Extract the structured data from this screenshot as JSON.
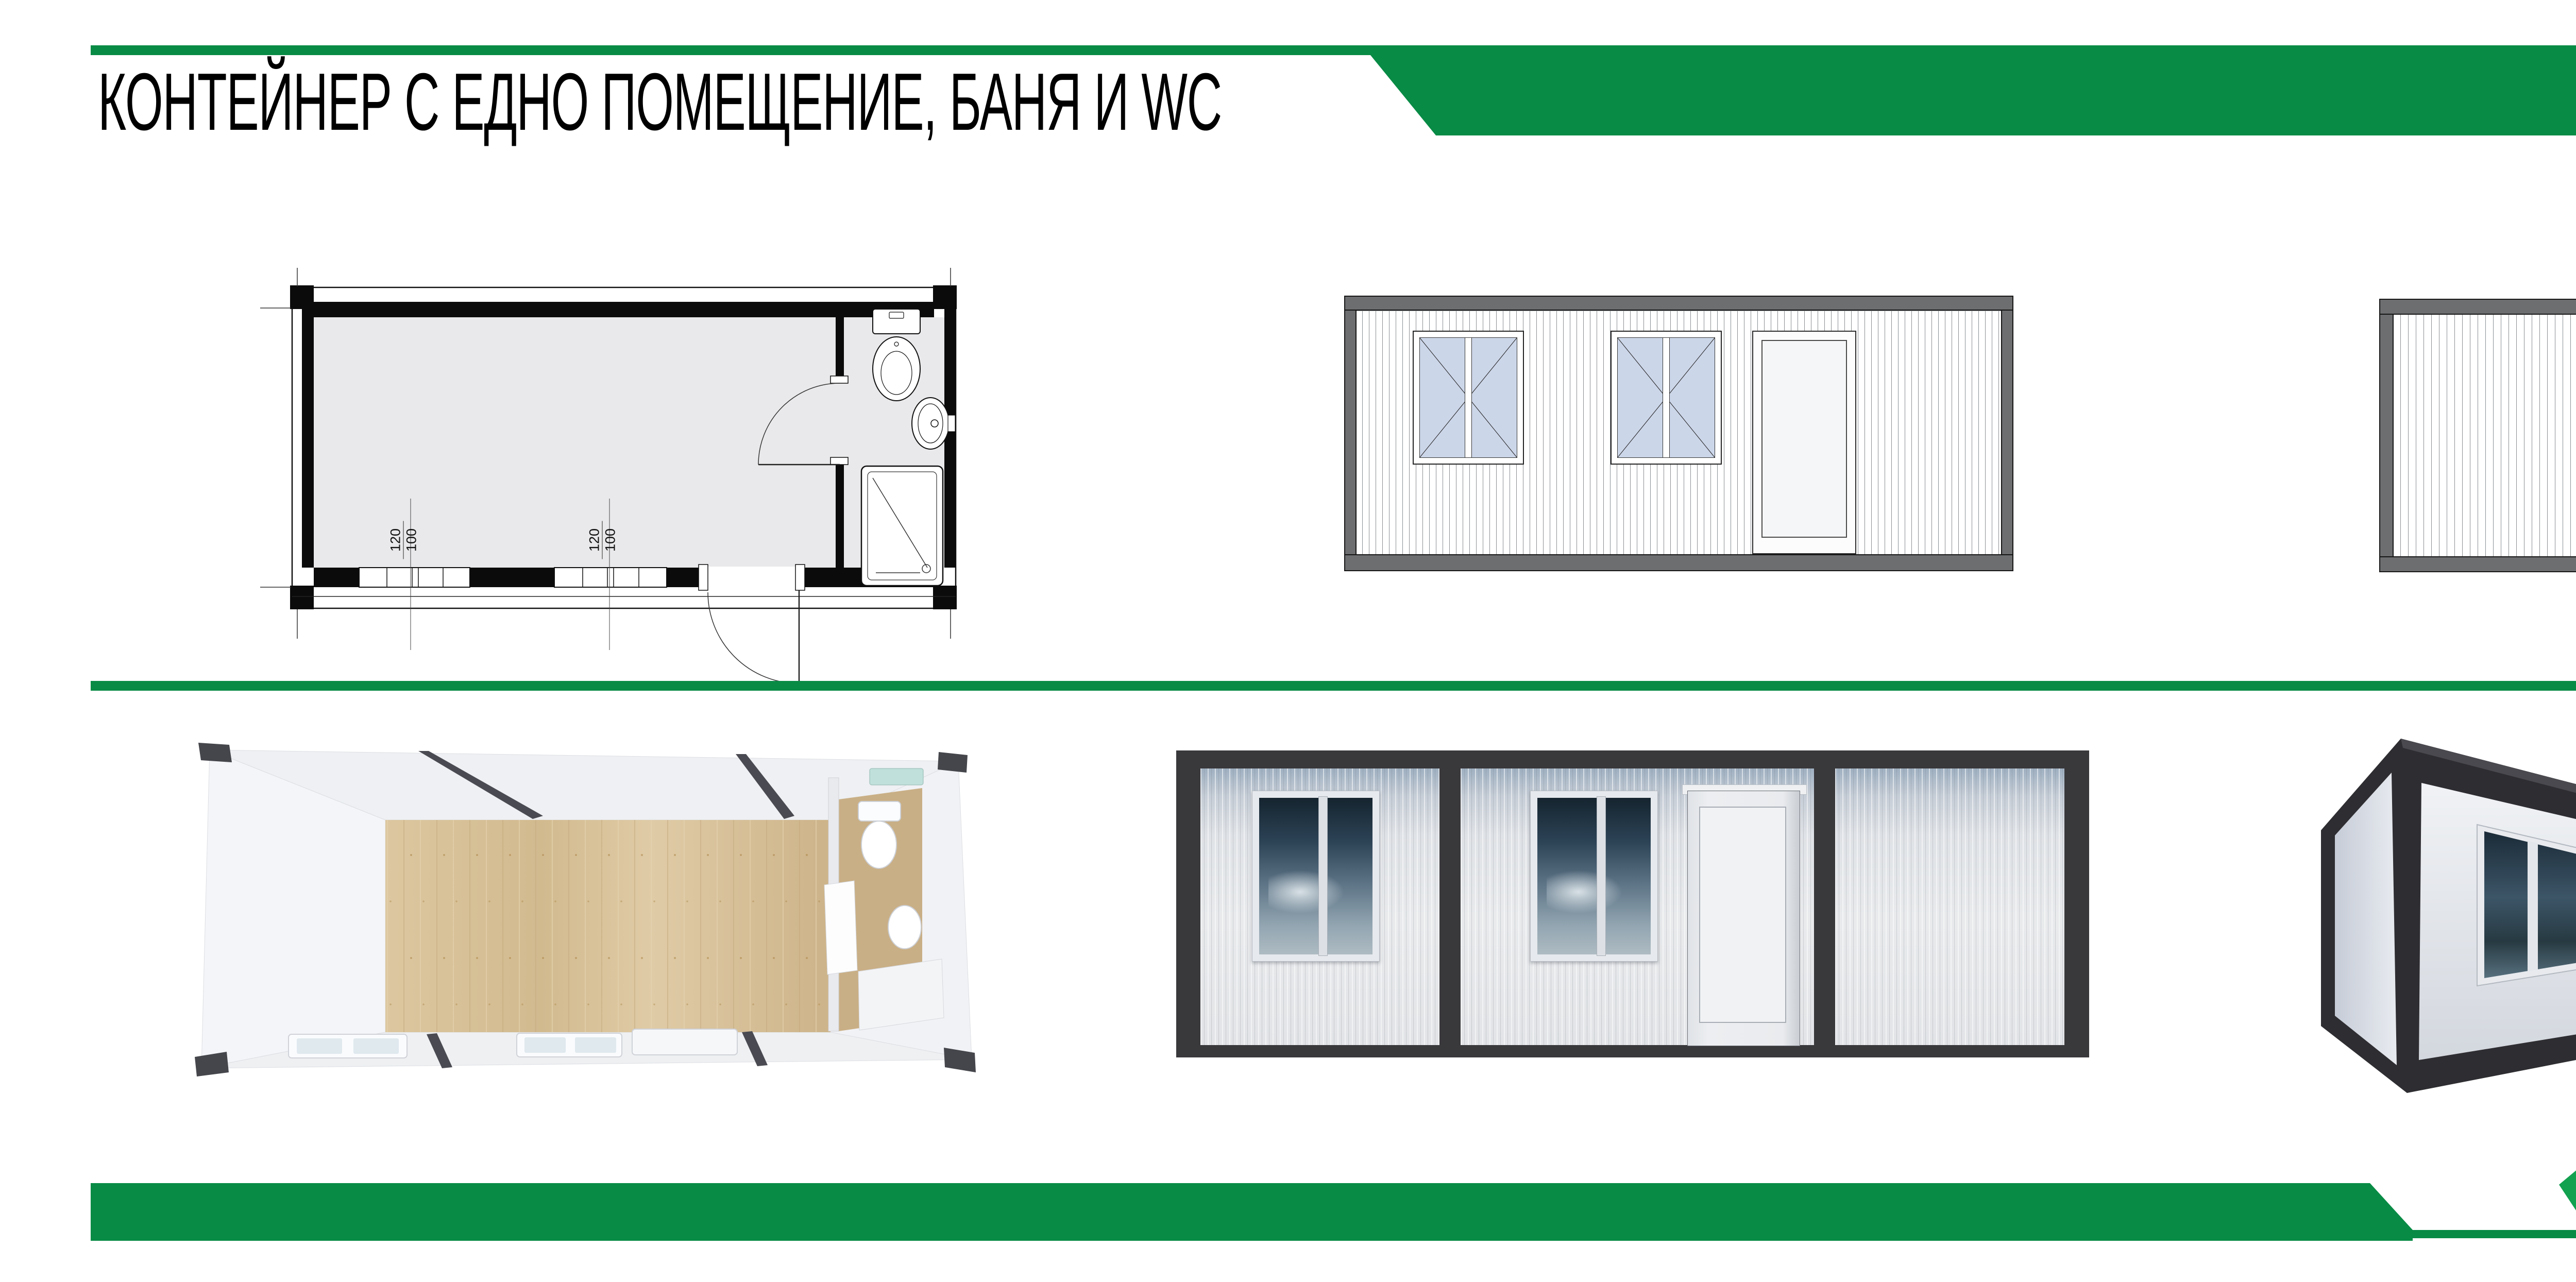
{
  "header": {
    "title": "КОНТЕЙНЕР С ЕДНО ПОМЕЩЕНИЕ, БАНЯ И WC",
    "page_number": "0 0 8"
  },
  "plan": {
    "dims": [
      {
        "width": "120",
        "height": "100"
      },
      {
        "width": "120",
        "height": "100"
      }
    ]
  },
  "footer": {
    "brand": "LINA"
  },
  "colors": {
    "accent_green": "#088B45",
    "render_frame_dark": "#39383B",
    "elevation_frame_gray": "#6D6E70",
    "glass_blue": "#CCD6E9",
    "wood_floor": "#D9C49E"
  }
}
